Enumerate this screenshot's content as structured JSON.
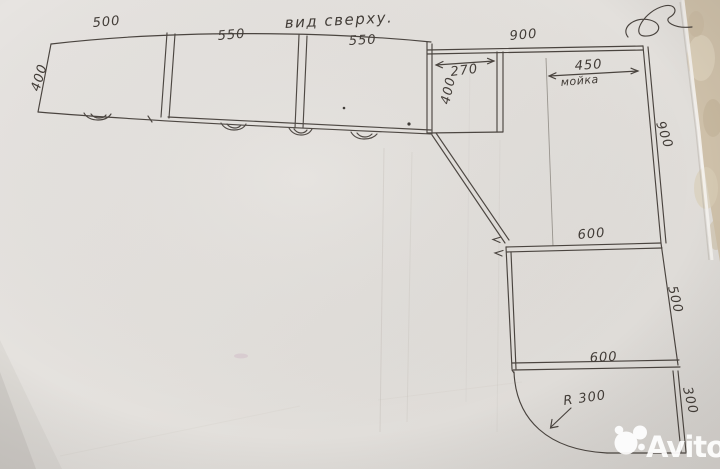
{
  "scene": {
    "view_note": "вид  сверху.",
    "watermark": "Avito"
  },
  "labels": {
    "box1_width": "500",
    "box2_width": "550",
    "box3_width": "550",
    "run_depth": "400",
    "right_total_width": "900",
    "corner_inner_width": "270",
    "corner_depth": "400",
    "sink_width": "450",
    "sink_note": "мойка",
    "right_side_depth": "900",
    "mid_top_width": "600",
    "mid_side_depth": "500",
    "mid_bottom_width": "600",
    "end_side_depth": "300",
    "corner_radius": "R 300"
  },
  "colors": {
    "paper": "#e5e2de",
    "ink": "#4a443f",
    "fabric_background": "#cfc1aa",
    "watermark": "#ffffff"
  }
}
